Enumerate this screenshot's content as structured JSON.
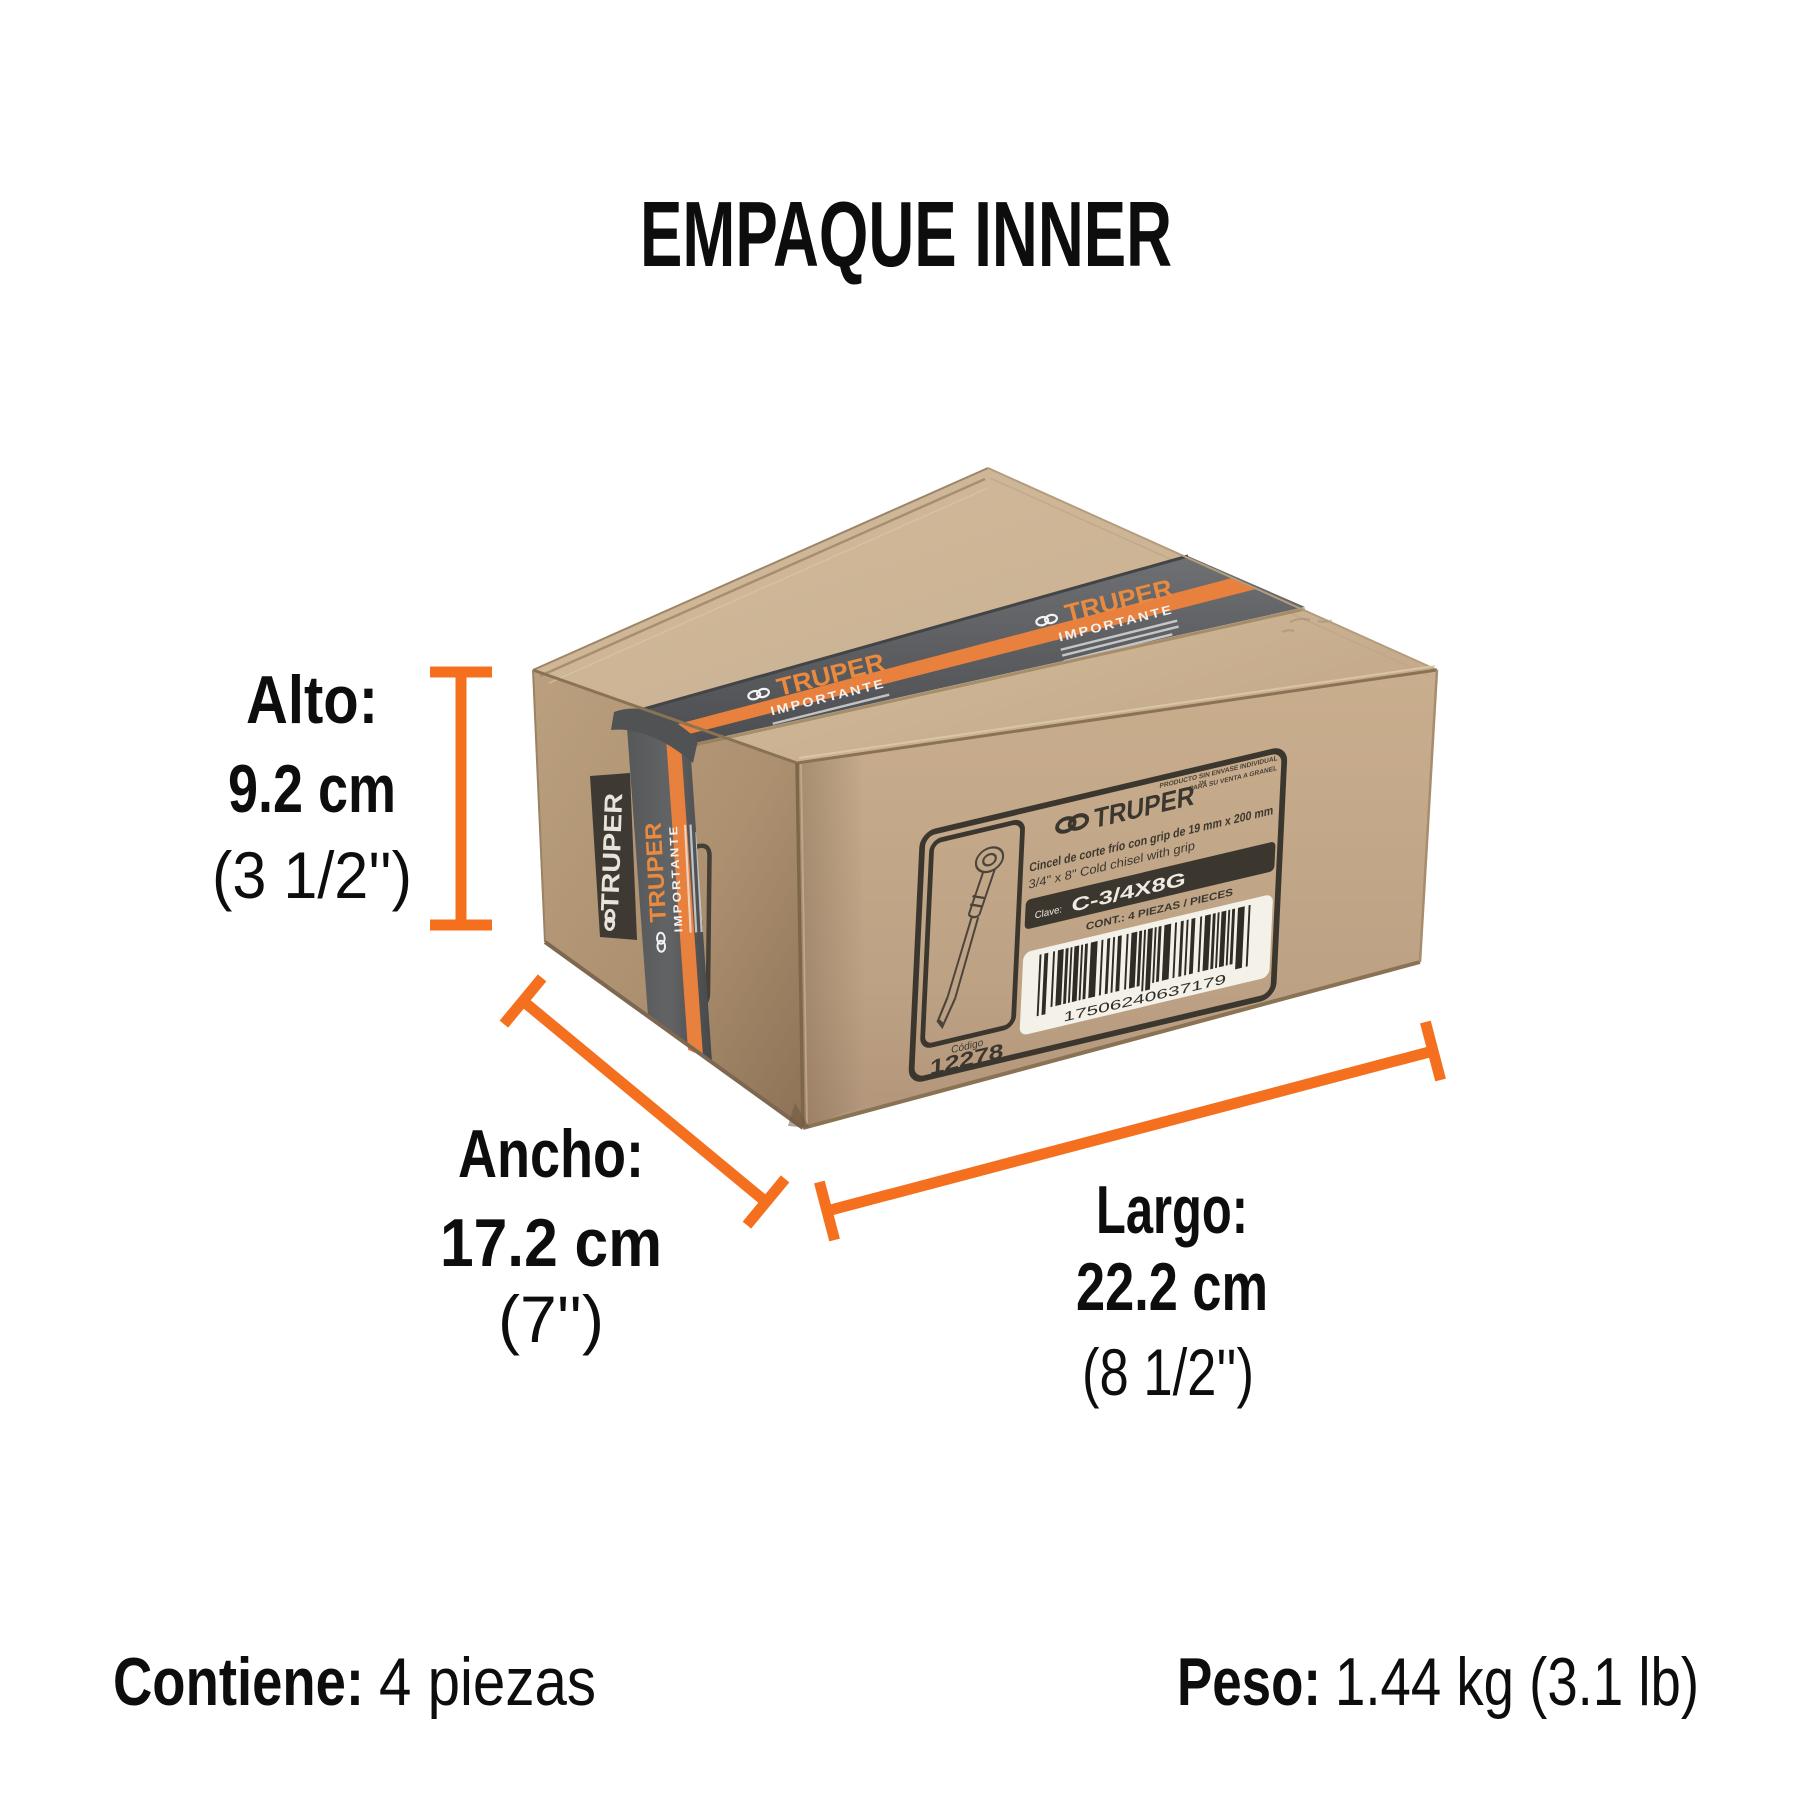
{
  "title": "EMPAQUE INNER",
  "colors": {
    "accent_orange": "#f4701f",
    "tape_stripe_orange": "#e8813d",
    "tape_gray": "#5c5d5f",
    "cardboard_top": "#cbb394",
    "cardboard_front": "#c2a787",
    "cardboard_side": "#ab8f70",
    "label_ink": "#3b372f",
    "text_black": "#0d0d0d"
  },
  "dimensions": {
    "alto": {
      "label": "Alto:",
      "metric": "9.2 cm",
      "imperial": "(3 1/2'')"
    },
    "ancho": {
      "label": "Ancho:",
      "metric": "17.2 cm",
      "imperial": "(7'')"
    },
    "largo": {
      "label": "Largo:",
      "metric": "22.2 cm",
      "imperial": "(8 1/2'')"
    }
  },
  "footer": {
    "contains_label": "Contiene:",
    "contains_value": "4 piezas",
    "weight_label": "Peso:",
    "weight_value": "1.44 kg (3.1 lb)"
  },
  "box_label": {
    "brand": "TRUPER",
    "trademark": "™",
    "disclaimer_line1": "PRODUCTO SIN ENVASE INDIVIDUAL",
    "disclaimer_line2": "PARA SU VENTA A GRANEL",
    "product_es": "Cincel de corte frío con grip de 19 mm x 200 mm",
    "product_en": "3/4\" x 8\" Cold chisel with grip",
    "clave_label": "Clave:",
    "clave_value": "C-3/4X8G",
    "content_line": "CONT.: 4 PIEZAS / PIECES",
    "barcode_number": "17506240637179",
    "codigo_label": "Código",
    "codigo_value": "12278"
  },
  "tape": {
    "brand": "TRUPER",
    "word": "IMPORTANTE"
  }
}
